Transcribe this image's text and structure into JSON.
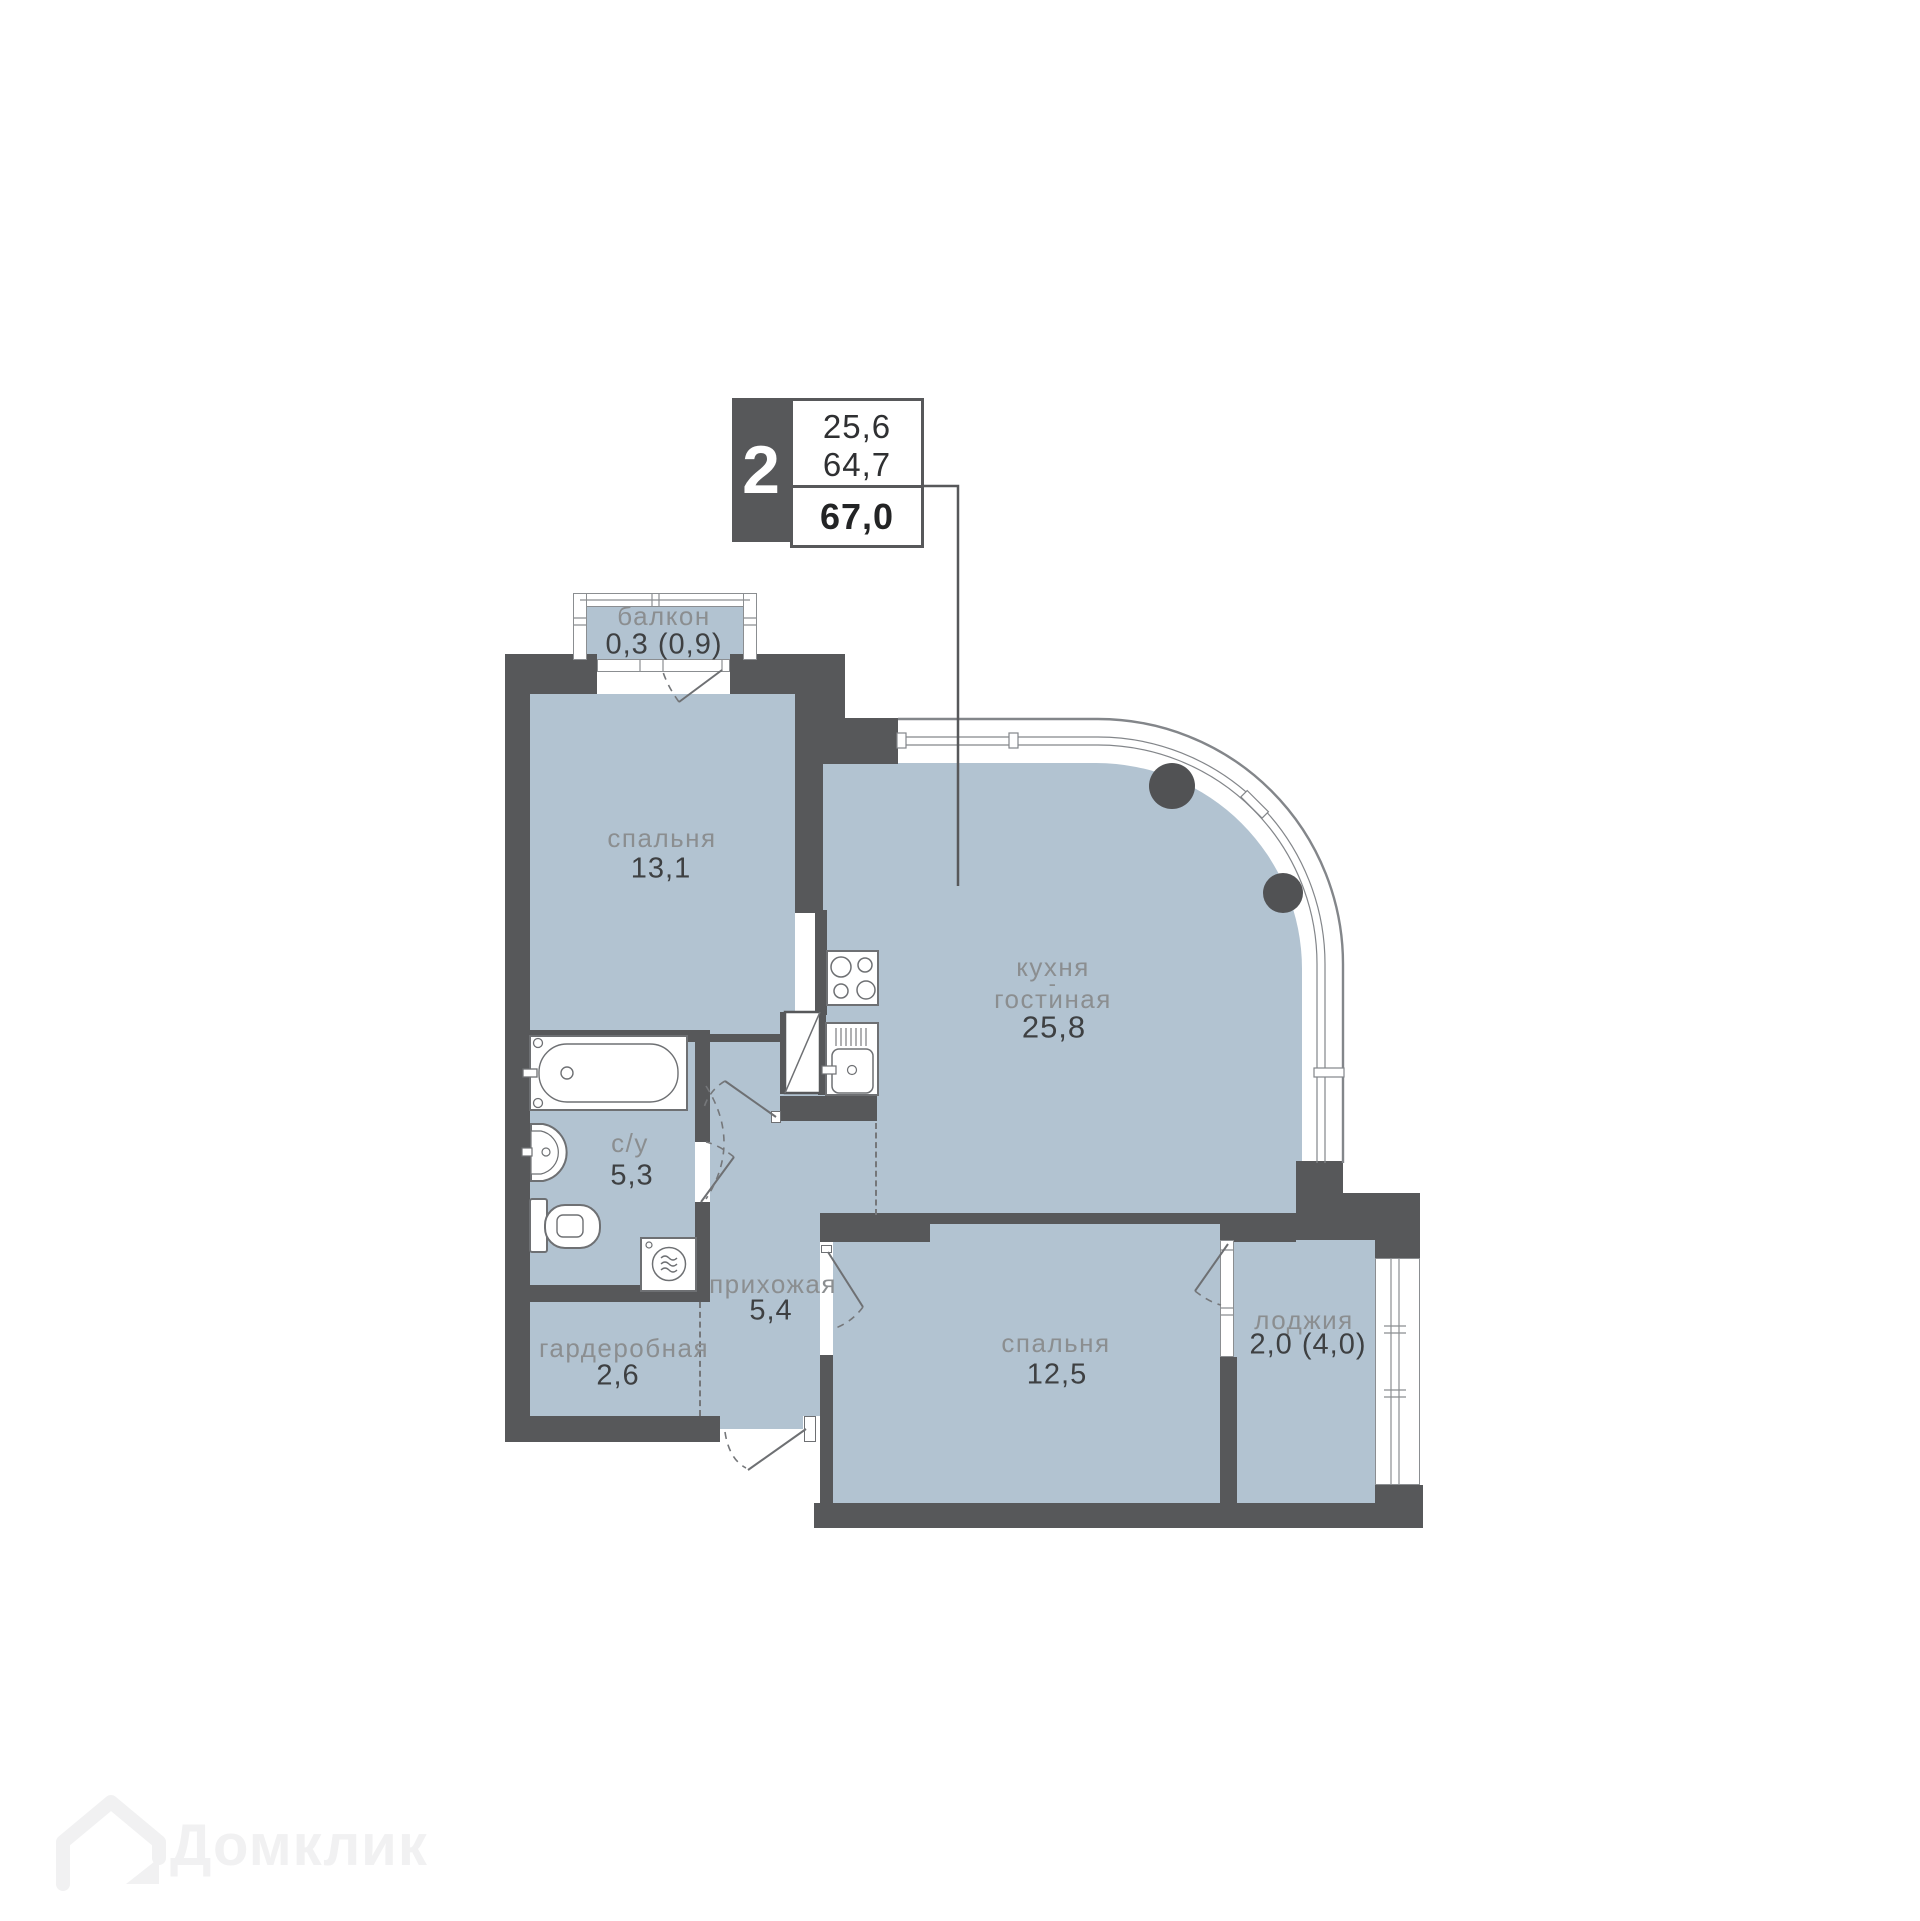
{
  "badge": {
    "room_count": "2",
    "values": [
      "25,6",
      "64,7"
    ],
    "total": "67,0"
  },
  "rooms": {
    "balcony": {
      "name": "балкон",
      "area": "0,3 (0,9)"
    },
    "bedroom1": {
      "name": "спальня",
      "area": "13,1"
    },
    "kitchen": {
      "line1": "кухня",
      "sep": "-",
      "line2": "гостиная",
      "area": "25,8"
    },
    "bathroom": {
      "name": "с/у",
      "area": "5,3"
    },
    "hallway": {
      "name": "прихожая",
      "area": "5,4"
    },
    "wardrobe": {
      "name": "гардеробная",
      "area": "2,6"
    },
    "bedroom2": {
      "name": "спальня",
      "area": "12,5"
    },
    "loggia": {
      "name": "лоджия",
      "area": "2,0 (4,0)"
    }
  },
  "watermark": {
    "brand": "Домклик"
  },
  "colors": {
    "wall": "#57585a",
    "floor": "#b2c3d1",
    "accent_text": "#3e4042",
    "label_text": "#8b8e90"
  }
}
